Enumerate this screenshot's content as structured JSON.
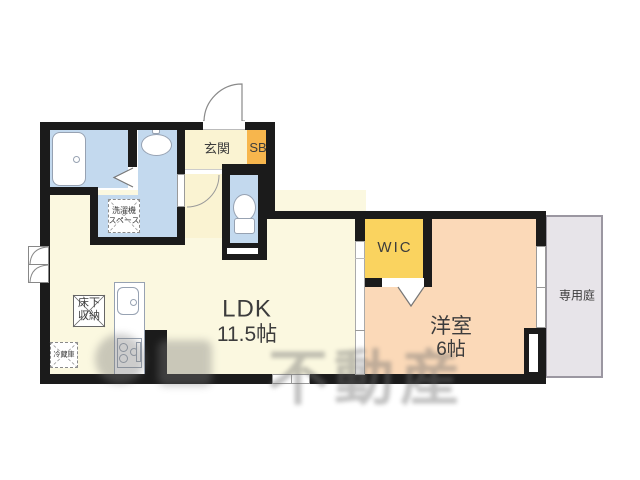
{
  "plan": {
    "title": "1LDK floor plan",
    "rooms": {
      "ldk": {
        "label": "LDK",
        "area": "11.5帖"
      },
      "bedroom": {
        "label": "洋室",
        "area": "6帖"
      },
      "wic": {
        "label": "WIC"
      },
      "genkan": {
        "label": "玄関"
      },
      "shoebox": {
        "label": "SB"
      },
      "garden": {
        "label": "専用庭"
      },
      "floor_storage": {
        "line1": "床下",
        "line2": "収納"
      },
      "fridge": {
        "label": "冷蔵庫"
      },
      "washer": {
        "line1": "洗濯機",
        "line2": "スペース"
      }
    },
    "watermark": "不動産",
    "colors": {
      "wall": "#1b1b1b",
      "pale": "#fbf8e0",
      "pale2": "#faf3d2",
      "blue": "#c3d9ee",
      "peach": "#fbd9b8",
      "wic": "#fad35f",
      "orange": "#f7b64d",
      "garden": "#e7e4e9",
      "line": "#97a2b2",
      "label": "#3c3c3c"
    }
  }
}
